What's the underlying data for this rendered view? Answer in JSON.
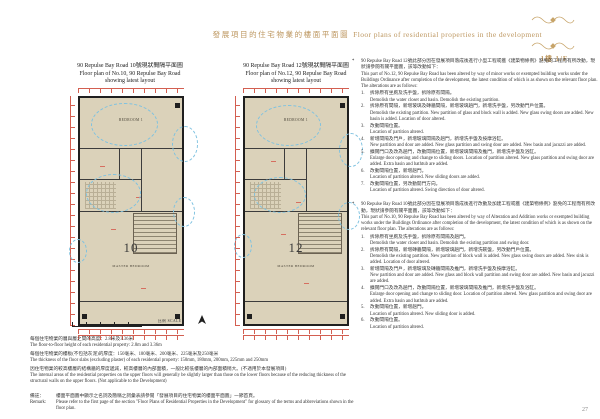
{
  "header": {
    "title_zh": "發展項目的住宅物業的樓面平面圖",
    "title_en": "Floor plans of residential properties in the development",
    "floor_label": "1樓  1/F"
  },
  "plans": [
    {
      "title_zh": "90 Repulse Bay Road 10號現狀間隔平面圖",
      "title_en1": "Floor plan of No.10, 90 Repulse Bay Road",
      "title_en2": "showing latest layout",
      "number": "10",
      "room_top": "BEDROOM 1",
      "room_bottom": "MASTER BEDROOM"
    },
    {
      "title_zh": "90 Repulse Bay Road 12號現狀間隔平面圖",
      "title_en1": "Floor plan of No.12, 90 Repulse Bay Road",
      "title_en2": "showing latest layout",
      "number": "12",
      "room_top": "BEDROOM 1",
      "room_bottom": "MASTER BEDROOM"
    }
  ],
  "scale": {
    "label": "比例 SCALE"
  },
  "notes": [
    {
      "zh": "每個住宅物業的層與層之間的高度：2.8米及3.36米",
      "en": "The floor-to-floor height of each residential property: 2.8m and 3.36m"
    },
    {
      "zh": "每個住宅物業的樓板(不包括灰泥)的厚度：150毫米、180毫米、200毫米、225毫米及250毫米",
      "en": "The thickness of the floor slabs (excluding plaster) of each residential property: 150mm, 180mm, 200mm, 225mm and 250mm"
    },
    {
      "zh": "因住宅物業的較高樓層的結構牆的厚度遞減，較高樓層的內部面積，一般比較低樓層的內部面積稍大。(不適用於本發展項目)",
      "en": "The internal areas of the residential properties on the upper floors will generally be slightly larger than those on the lower floors because of the reducing thickness of the structural walls on the upper floors. (Not applicable to the Development)"
    }
  ],
  "remark": {
    "zh_label": "備註：",
    "zh": "樓面平面圖中顯示之名詞及簡稱之詞彙表請參閱「發展項目的住宅物業的樓面平面圖」一節首頁。",
    "en_label": "Remark:",
    "en": "Please refer to the first page of the section \"Floor Plans of Residential Properties in the Development\" for glossary of the terms and abbreviations shown in the floor plan."
  },
  "alterations": [
    {
      "marker": "*",
      "intro_zh": "90 Repulse Bay Road 12號此部分因在發展項目落成後進行小型工程或獲《建築物條例》豁免的工程而有所改動，現狀請參閱有關平面圖，該等改動如下：",
      "intro_en": "This part of No.12, 90 Repulse Bay Road has been altered by way of minor works or exempted building works under the Buildings Ordinance after completion of the development, the latest condition of which is as shown on the relevant floor plan. The alterations are as follows:",
      "items": [
        {
          "no": "1.",
          "zh": "拆除原有坐廁及洗手盤，拆除原有間隔。",
          "en": "Demolish the water closet and basin. Demolish the existing partition."
        },
        {
          "no": "2.",
          "zh": "拆除原有間隔，新增玻璃及磚牆間隔，新增玻璃趟門，新增洗手盤，另改動門戶位置。",
          "en": "Demolish the existing partition. New partition of glass and block wall is added. New glass swing doors are added. New basin is added. Location of door altered."
        },
        {
          "no": "3.",
          "zh": "改動間隔位置。",
          "en": "Location of partition altered."
        },
        {
          "no": "4.",
          "zh": "新增間隔及門戶，新增玻璃間隔及趟門，新增洗手盤及按摩浴缸。",
          "en": "New partition and door are added. New glass partition and swing door are added. New basin and jacuzzi are added."
        },
        {
          "no": "5.",
          "zh": "擴闊門口及改為趟門，改動間隔位置，新增玻璃間隔及推門，新增洗手盤及浴缸。",
          "en": "Enlarge door opening and change to sliding doors. Location of partition altered. New glass partition and swing door are added. Extra basin and bathtub are added."
        },
        {
          "no": "6.",
          "zh": "改動間隔位置，新增趟門。",
          "en": "Location of partition altered. New sliding doors are added."
        },
        {
          "no": "7.",
          "zh": "改動間隔位置，另改動開門方向。",
          "en": "Location of partition altered. Swing direction of door altered."
        }
      ]
    },
    {
      "marker": "*",
      "intro_zh": "90 Repulse Bay Road 10號此部分因在發展項目落成後進行改動及加建工程或獲《建築物條例》豁免的工程而有所改動，現狀請參閱有關平面圖，該等改動如下：",
      "intro_en": "This part of No.10, 90 Repulse Bay Road has been altered by way of Alteration and Addition works or exempted building works under the Buildings Ordinance after completion of the development, the latest condition of which is as shown on the relevant floor plan. The alterations are as follows:",
      "items": [
        {
          "no": "1.",
          "zh": "拆除原有坐廁及洗手盤，拆除原有間隔及趟門。",
          "en": "Demolish the water closet and basin. Demolish the existing partition and swing door."
        },
        {
          "no": "2.",
          "zh": "拆除原有間隔，新增磚牆間隔，新增玻璃趟門，新增洗碗盤，另改動門戶位置。",
          "en": "Demolish the existing partition. New partition of block wall is added. New glass swing doors are added. New sink is added. Location of door altered."
        },
        {
          "no": "3.",
          "zh": "新增間隔及門戶，新增玻璃及磚牆間隔及推門，新增洗手盤及按摩浴缸。",
          "en": "New partition and door are added. New glass and block wall partition and swing door are added. New basin and jacuzzi are added."
        },
        {
          "no": "4.",
          "zh": "擴闊門口及改為趟門，改動間隔位置，新增玻璃間隔及推門，新增洗手盤及浴缸。",
          "en": "Enlarge door opening and change to sliding door. Location of partition altered. New glass partition and swing door are added. Extra basin and bathtub are added."
        },
        {
          "no": "5.",
          "zh": "改動間隔位置，新增趟門。",
          "en": "Location of partition altered. New sliding door is added."
        },
        {
          "no": "6.",
          "zh": "改動間隔位置。",
          "en": "Location of partition altered."
        }
      ]
    }
  ],
  "page_number": "27"
}
